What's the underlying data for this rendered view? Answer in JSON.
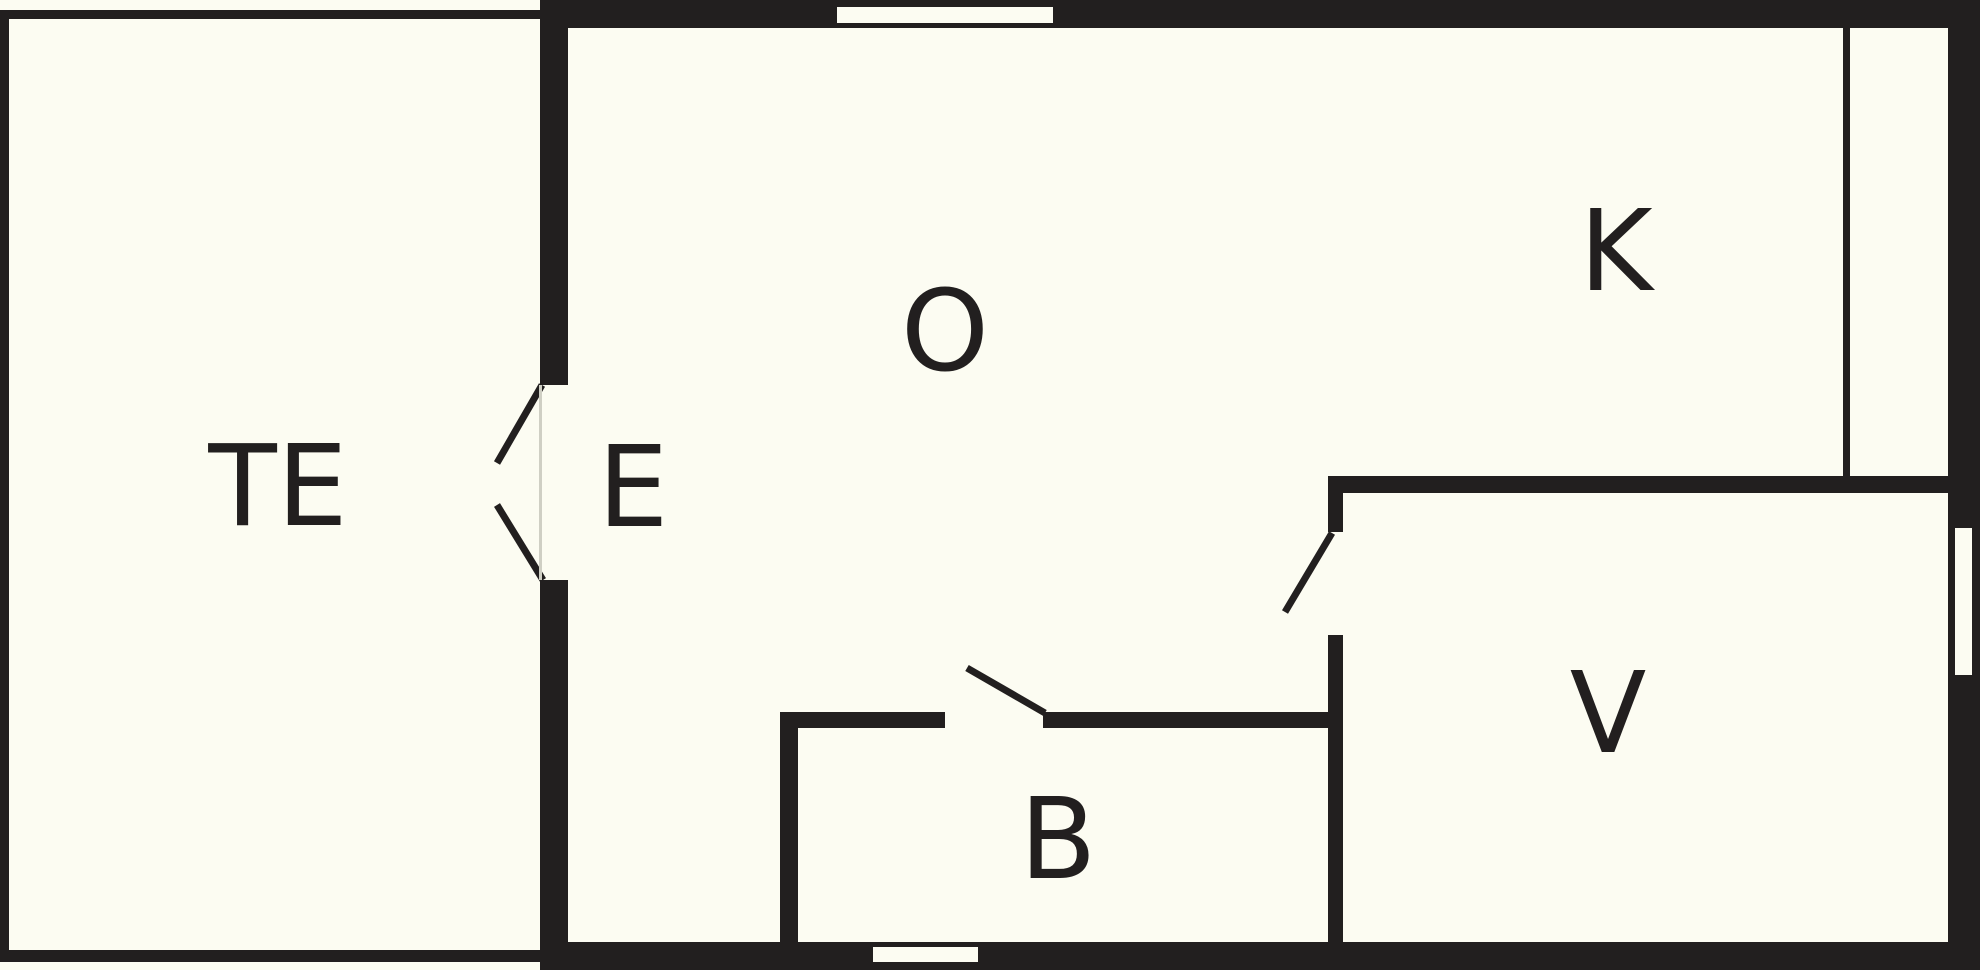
{
  "plan": {
    "title": "floor plan",
    "canvas": {
      "width": 1980,
      "height": 970
    },
    "colors": {
      "background": "#FCFCF2",
      "wall": "#221F1F",
      "label": "#221F1F",
      "threshold": "#CFCFC4"
    },
    "rooms": [
      {
        "id": "te",
        "label": "TE",
        "cx": 278,
        "cy": 487
      },
      {
        "id": "e",
        "label": "E",
        "cx": 633,
        "cy": 488
      },
      {
        "id": "o",
        "label": "O",
        "cx": 945,
        "cy": 332
      },
      {
        "id": "k",
        "label": "K",
        "cx": 1616,
        "cy": 252
      },
      {
        "id": "b",
        "label": "B",
        "cx": 1058,
        "cy": 840
      },
      {
        "id": "v",
        "label": "V",
        "cx": 1608,
        "cy": 714
      }
    ],
    "walls": [
      {
        "name": "te-left-wall",
        "x": 0,
        "y": 10,
        "w": 9,
        "h": 952
      },
      {
        "name": "te-top-wall",
        "x": 0,
        "y": 10,
        "w": 540,
        "h": 9
      },
      {
        "name": "te-bottom-wall",
        "x": 0,
        "y": 950,
        "w": 540,
        "h": 12
      },
      {
        "name": "main-top-wall",
        "x": 540,
        "y": 0,
        "w": 1440,
        "h": 28
      },
      {
        "name": "right-outer-wall",
        "x": 1948,
        "y": 0,
        "w": 32,
        "h": 970
      },
      {
        "name": "main-bottom-wall",
        "x": 540,
        "y": 942,
        "w": 1440,
        "h": 28
      },
      {
        "name": "entry-divider-upper",
        "x": 540,
        "y": 0,
        "w": 28,
        "h": 385
      },
      {
        "name": "entry-divider-lower",
        "x": 540,
        "y": 580,
        "w": 28,
        "h": 390
      },
      {
        "name": "kitchen-divider-line",
        "x": 1843,
        "y": 28,
        "w": 7,
        "h": 449
      },
      {
        "name": "v-room-top-wall",
        "x": 1328,
        "y": 476,
        "w": 622,
        "h": 17
      },
      {
        "name": "v-room-left-wall-upper",
        "x": 1328,
        "y": 476,
        "w": 15,
        "h": 56
      },
      {
        "name": "v-room-left-wall-lower",
        "x": 1328,
        "y": 635,
        "w": 15,
        "h": 313
      },
      {
        "name": "b-room-left-wall",
        "x": 780,
        "y": 712,
        "w": 18,
        "h": 230
      },
      {
        "name": "b-room-top-wall-left",
        "x": 780,
        "y": 712,
        "w": 165,
        "h": 16
      },
      {
        "name": "b-room-top-wall-right",
        "x": 1043,
        "y": 712,
        "w": 300,
        "h": 16
      }
    ],
    "window_openings": [
      {
        "name": "top-wall-window",
        "x": 837,
        "y": 7,
        "w": 216,
        "h": 16
      },
      {
        "name": "right-wall-window",
        "x": 1955,
        "y": 528,
        "w": 17,
        "h": 147
      },
      {
        "name": "bottom-wall-window",
        "x": 873,
        "y": 947,
        "w": 105,
        "h": 15
      }
    ],
    "door_swing_lines": [
      {
        "name": "entry-door-swing-upper",
        "x1": 542,
        "y1": 385,
        "x2": 497,
        "y2": 463
      },
      {
        "name": "entry-door-swing-lower",
        "x1": 497,
        "y1": 505,
        "x2": 543,
        "y2": 580
      },
      {
        "name": "b-room-door-swing",
        "x1": 967,
        "y1": 668,
        "x2": 1045,
        "y2": 713
      },
      {
        "name": "v-room-door-swing",
        "x1": 1285,
        "y1": 612,
        "x2": 1332,
        "y2": 533
      }
    ],
    "thresholds": [
      {
        "name": "entry-door-threshold",
        "x": 539,
        "y": 385,
        "w": 3,
        "h": 195
      }
    ]
  }
}
